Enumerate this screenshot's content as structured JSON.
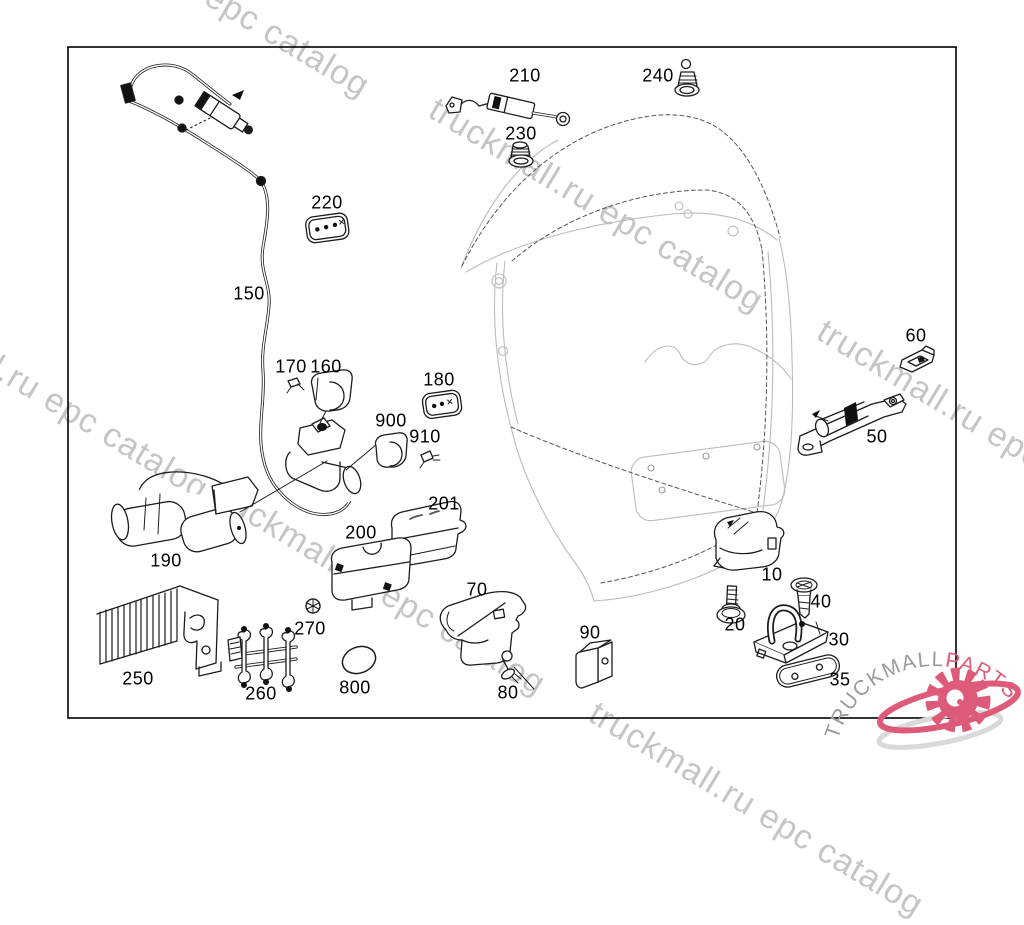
{
  "watermark": {
    "text": "truckmall.ru epc catalog",
    "color": "#c5c5c5",
    "instances": [
      {
        "x": 48,
        "y": -125
      },
      {
        "x": 442,
        "y": 90
      },
      {
        "x": 830,
        "y": 312
      },
      {
        "x": -113,
        "y": 278
      },
      {
        "x": 224,
        "y": 473
      },
      {
        "x": 602,
        "y": 694
      }
    ]
  },
  "logo": {
    "brand": "TRUCKMALL",
    "suffix": "PARTS",
    "gray": "#9b9b9b",
    "pink": "#dd5a78"
  },
  "part_labels": [
    {
      "id": "210",
      "label": "210",
      "x": 525,
      "y": 76
    },
    {
      "id": "240",
      "label": "240",
      "x": 658,
      "y": 76
    },
    {
      "id": "230",
      "label": "230",
      "x": 521,
      "y": 134
    },
    {
      "id": "220",
      "label": "220",
      "x": 327,
      "y": 203
    },
    {
      "id": "150",
      "label": "150",
      "x": 249,
      "y": 294
    },
    {
      "id": "170",
      "label": "170",
      "x": 291,
      "y": 367
    },
    {
      "id": "160",
      "label": "160",
      "x": 326,
      "y": 367
    },
    {
      "id": "180",
      "label": "180",
      "x": 439,
      "y": 380
    },
    {
      "id": "900",
      "label": "900",
      "x": 391,
      "y": 421
    },
    {
      "id": "910",
      "label": "910",
      "x": 425,
      "y": 437
    },
    {
      "id": "201",
      "label": "201",
      "x": 444,
      "y": 504
    },
    {
      "id": "200",
      "label": "200",
      "x": 361,
      "y": 533
    },
    {
      "id": "190",
      "label": "190",
      "x": 166,
      "y": 561
    },
    {
      "id": "250",
      "label": "250",
      "x": 138,
      "y": 679
    },
    {
      "id": "260",
      "label": "260",
      "x": 261,
      "y": 694
    },
    {
      "id": "270",
      "label": "270",
      "x": 310,
      "y": 629
    },
    {
      "id": "800",
      "label": "800",
      "x": 355,
      "y": 688
    },
    {
      "id": "70",
      "label": "70",
      "x": 477,
      "y": 590
    },
    {
      "id": "80",
      "label": "80",
      "x": 508,
      "y": 693
    },
    {
      "id": "90",
      "label": "90",
      "x": 590,
      "y": 633
    },
    {
      "id": "10",
      "label": "10",
      "x": 772,
      "y": 575
    },
    {
      "id": "20",
      "label": "20",
      "x": 735,
      "y": 625
    },
    {
      "id": "40",
      "label": "40",
      "x": 821,
      "y": 602
    },
    {
      "id": "30",
      "label": "30",
      "x": 839,
      "y": 640
    },
    {
      "id": "35",
      "label": "35",
      "x": 840,
      "y": 680
    },
    {
      "id": "50",
      "label": "50",
      "x": 877,
      "y": 437
    },
    {
      "id": "60",
      "label": "60",
      "x": 916,
      "y": 336
    }
  ]
}
